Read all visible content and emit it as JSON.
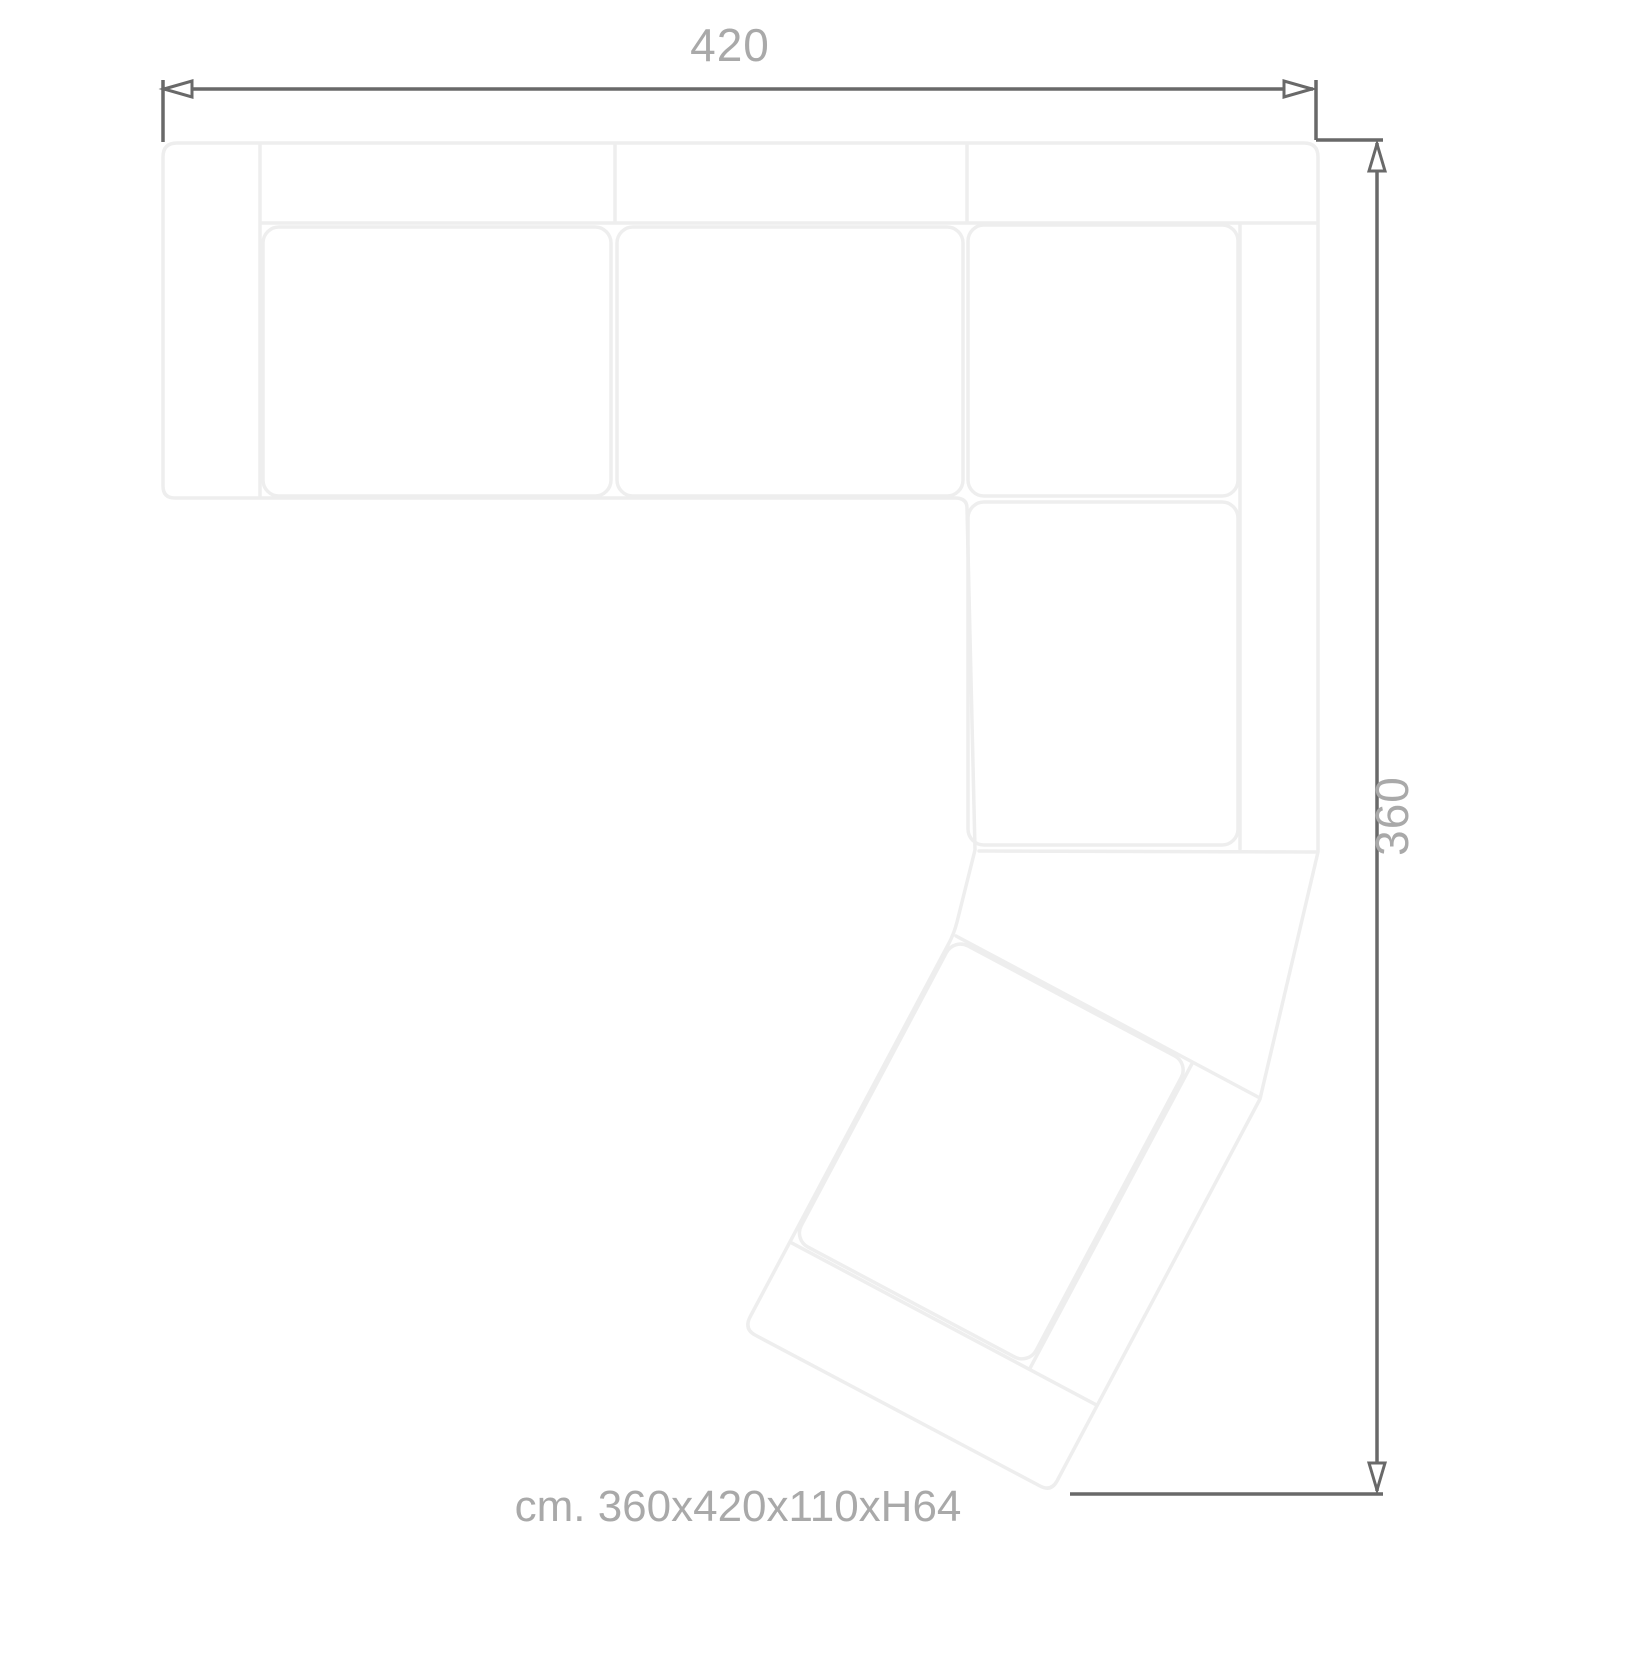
{
  "drawing": {
    "type": "sofa-top-view-technical-drawing",
    "top_dimension": "420",
    "right_dimension": "360",
    "caption": "cm. 360x420x110xH64"
  },
  "colors": {
    "background": "#ffffff",
    "sofa_outline": "#eeeeee",
    "dimension_line": "#696969",
    "label_text": "#a9a9a9"
  }
}
